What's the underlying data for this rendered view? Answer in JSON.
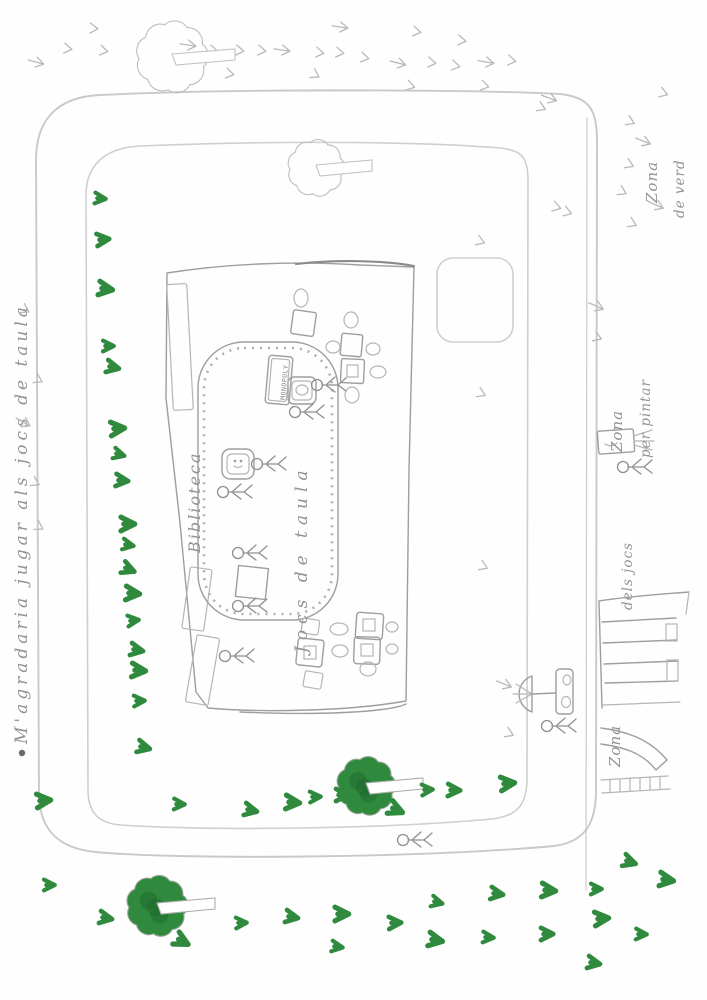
{
  "colors": {
    "marker_green": "#2f8a3e",
    "marker_green_dark": "#1e662c",
    "pencil": "#b9b9b9",
    "pencil_dark": "#8f8f8f",
    "paper": "#fefefe"
  },
  "labels": {
    "map_title": "M'agradaria jugar als jocs de taula",
    "zona_verd_line1": "Zona",
    "zona_verd_line2": "de verd",
    "zona_pintar_line1": "Zona",
    "zona_pintar_line2": "per pintar",
    "zona_jocs_line1": "Zona",
    "zona_jocs_line2": "dels jocs",
    "biblioteca": "Biblioteca",
    "jocs_de_taula": "Jocs de taula",
    "monopoly": "MONOPOLY"
  },
  "green_marks": [
    [
      95,
      198,
      5
    ],
    [
      97,
      240,
      -5
    ],
    [
      99,
      288,
      8
    ],
    [
      103,
      346,
      0
    ],
    [
      107,
      366,
      12
    ],
    [
      111,
      429,
      -4
    ],
    [
      114,
      453,
      15
    ],
    [
      116,
      480,
      5
    ],
    [
      121,
      524,
      0
    ],
    [
      123,
      544,
      10
    ],
    [
      123,
      567,
      22
    ],
    [
      126,
      593,
      4
    ],
    [
      128,
      621,
      -6
    ],
    [
      131,
      649,
      10
    ],
    [
      132,
      670,
      4
    ],
    [
      134,
      701,
      -2
    ],
    [
      138,
      746,
      14
    ],
    [
      37,
      801,
      -4
    ],
    [
      174,
      804,
      2
    ],
    [
      245,
      809,
      12
    ],
    [
      286,
      802,
      4
    ],
    [
      310,
      797,
      -2
    ],
    [
      336,
      795,
      0
    ],
    [
      390,
      807,
      24
    ],
    [
      422,
      790,
      -3
    ],
    [
      448,
      790,
      2
    ],
    [
      501,
      784,
      -5
    ],
    [
      44,
      885,
      0
    ],
    [
      100,
      917,
      10
    ],
    [
      176,
      938,
      28
    ],
    [
      236,
      923,
      -2
    ],
    [
      286,
      916,
      10
    ],
    [
      335,
      914,
      0
    ],
    [
      332,
      946,
      8
    ],
    [
      624,
      860,
      18
    ],
    [
      660,
      879,
      8
    ],
    [
      432,
      901,
      14
    ],
    [
      491,
      893,
      8
    ],
    [
      542,
      890,
      4
    ],
    [
      591,
      889,
      0
    ],
    [
      389,
      923,
      -2
    ],
    [
      429,
      939,
      10
    ],
    [
      483,
      937,
      4
    ],
    [
      541,
      934,
      0
    ],
    [
      595,
      919,
      -4
    ],
    [
      636,
      934,
      2
    ],
    [
      588,
      962,
      10
    ]
  ],
  "pencil_marks": [
    [
      36,
      62,
      15
    ],
    [
      64,
      48,
      10
    ],
    [
      90,
      28,
      5
    ],
    [
      100,
      50,
      12
    ],
    [
      188,
      45,
      8
    ],
    [
      210,
      50,
      10
    ],
    [
      236,
      50,
      8
    ],
    [
      258,
      50,
      10
    ],
    [
      282,
      50,
      8
    ],
    [
      316,
      52,
      10
    ],
    [
      226,
      73,
      12
    ],
    [
      312,
      73,
      30
    ],
    [
      340,
      27,
      8
    ],
    [
      336,
      52,
      10
    ],
    [
      361,
      57,
      12
    ],
    [
      413,
      31,
      10
    ],
    [
      398,
      63,
      14
    ],
    [
      428,
      62,
      10
    ],
    [
      458,
      40,
      8
    ],
    [
      452,
      65,
      12
    ],
    [
      486,
      62,
      10
    ],
    [
      407,
      85,
      16
    ],
    [
      481,
      85,
      14
    ],
    [
      508,
      60,
      10
    ],
    [
      549,
      98,
      20
    ],
    [
      538,
      106,
      25
    ],
    [
      660,
      92,
      20
    ],
    [
      627,
      120,
      25
    ],
    [
      643,
      141,
      22
    ],
    [
      626,
      163,
      25
    ],
    [
      619,
      190,
      28
    ],
    [
      629,
      222,
      25
    ],
    [
      656,
      205,
      24
    ],
    [
      553,
      206,
      18
    ],
    [
      564,
      211,
      20
    ],
    [
      477,
      240,
      22
    ],
    [
      596,
      306,
      24
    ],
    [
      594,
      336,
      22
    ],
    [
      478,
      392,
      25
    ],
    [
      480,
      565,
      24
    ],
    [
      504,
      684,
      22
    ],
    [
      506,
      732,
      25
    ],
    [
      22,
      308,
      30
    ],
    [
      35,
      378,
      28
    ],
    [
      23,
      422,
      30
    ],
    [
      32,
      481,
      28
    ],
    [
      36,
      525,
      30
    ]
  ],
  "trees": {
    "green": [
      {
        "x": 366,
        "y": 786,
        "r": 27
      },
      {
        "x": 157,
        "y": 906,
        "r": 28
      }
    ],
    "pencil": [
      {
        "x": 172,
        "y": 57,
        "r": 33
      },
      {
        "x": 316,
        "y": 168,
        "r": 26
      }
    ]
  },
  "figures": [
    [
      312,
      385
    ],
    [
      290,
      412
    ],
    [
      252,
      464
    ],
    [
      218,
      492
    ],
    [
      233,
      553
    ],
    [
      233,
      606
    ],
    [
      220,
      656
    ],
    [
      398,
      840
    ],
    [
      542,
      726
    ],
    [
      618,
      467
    ]
  ]
}
